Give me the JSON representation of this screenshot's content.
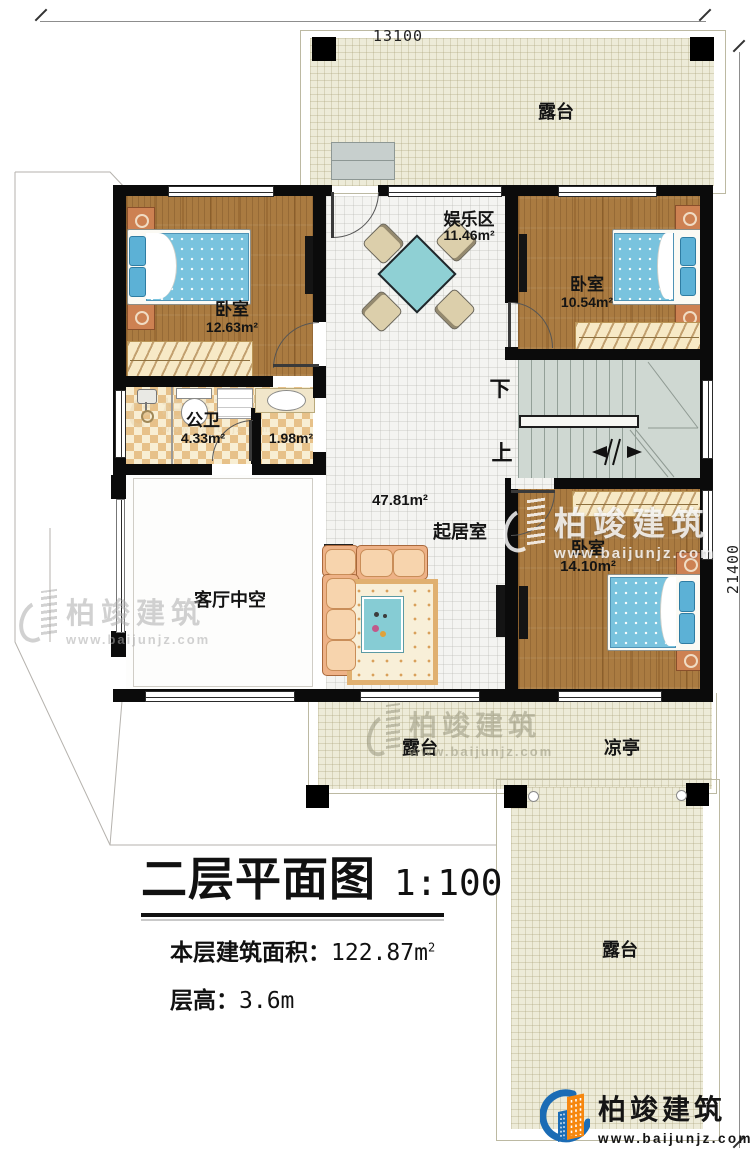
{
  "dimensions": {
    "top": "13100",
    "right": "21400"
  },
  "rooms": {
    "terrace_top": {
      "label": "露台"
    },
    "bedroom_left": {
      "label": "卧室",
      "area": "12.63m²"
    },
    "entertainment": {
      "label": "娱乐区",
      "area": "11.46m²"
    },
    "bedroom_right": {
      "label": "卧室",
      "area": "10.54m²"
    },
    "bathroom": {
      "label": "公卫",
      "area": "4.33m²"
    },
    "wash_room": {
      "area": "1.98m²"
    },
    "living_room": {
      "label": "起居室",
      "area": "47.81m²"
    },
    "void": {
      "label": "客厅中空"
    },
    "bedroom_bottom": {
      "label": "卧室",
      "area": "14.10m²"
    },
    "terrace_bottom": {
      "label": "露台"
    },
    "pavilion": {
      "label": "凉亭"
    },
    "terrace_right": {
      "label": "露台"
    }
  },
  "stairs": {
    "down_label": "下",
    "up_label": "上"
  },
  "title_block": {
    "title": "二层平面图",
    "scale": "1:100",
    "floor_area_label": "本层建筑面积：",
    "floor_area_value": "122.87m",
    "floor_area_sup": "2",
    "floor_height_label": "层高：",
    "floor_height_value": "3.6m"
  },
  "branding": {
    "company": "柏竣建筑",
    "website": "www.baijunjz.com",
    "logo_blue": "#1b6cb5",
    "logo_orange": "#f6870f"
  }
}
